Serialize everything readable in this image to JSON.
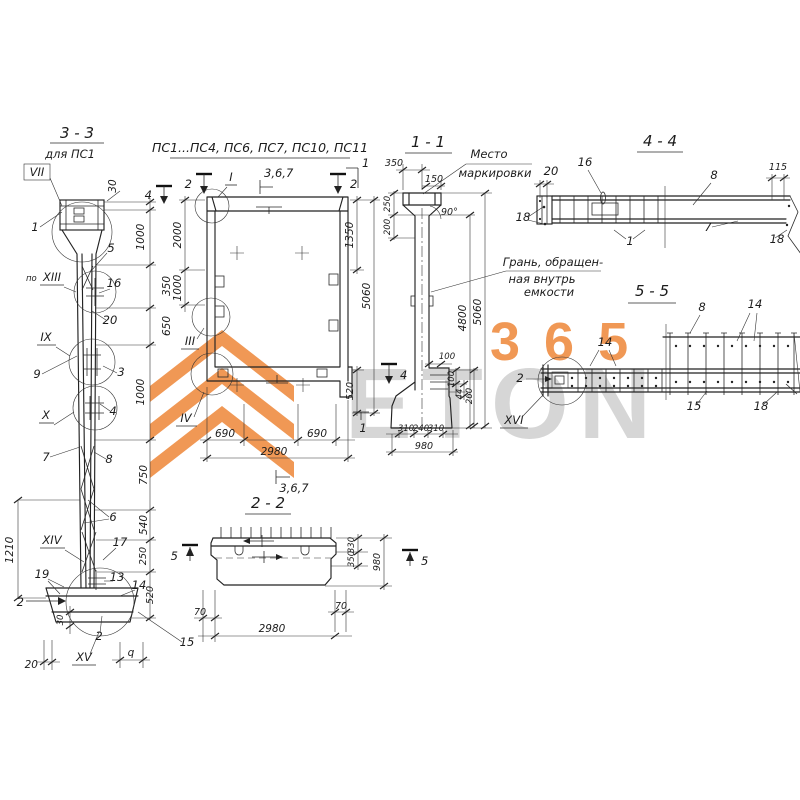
{
  "meta": {
    "bg": "#ffffff",
    "ink": "#222222"
  },
  "watermark": {
    "number": "365",
    "brand": "ETON",
    "orange": "#ee8a3e",
    "gray": "#cccccc"
  },
  "v33": {
    "title": "3 - 3",
    "subtitle": "для ПС1",
    "det_vii": "VII",
    "det_po": "по",
    "det_xiii": "XIII",
    "det_ix": "IX",
    "det_x": "X",
    "det_xiv": "XIV",
    "det_xv": "XV",
    "c1": "1",
    "c5": "5",
    "c16": "16",
    "c20": "20",
    "c9": "9",
    "c3": "3",
    "c4": "4",
    "c7": "7",
    "c8": "8",
    "c6": "6",
    "c17": "17",
    "c19": "19",
    "c13": "13",
    "c14": "14",
    "c2_side": "2",
    "c2_bottom": "2",
    "c15": "15",
    "cq": "q",
    "d30_top": "30",
    "d1000_a": "1000",
    "d350": "350",
    "d650": "650",
    "d1000_b": "1000",
    "d750": "750",
    "d540": "540",
    "d250": "250",
    "d520": "520",
    "d1210": "1210",
    "d30_base": "30",
    "d20": "20"
  },
  "vp": {
    "title": "ПС1...ПС4, ПС6, ПС7, ПС10, ПС11",
    "det_i": "I",
    "det_iii": "III",
    "det_iv": "IV",
    "mark2_left": "2",
    "mark2_right": "2",
    "mark1_top": "1",
    "mark1_bottom": "1",
    "mark4": "4",
    "g367_top": "3,6,7",
    "g367_bottom": "3,6,7",
    "d2000": "2000",
    "d1350": "1350",
    "d1000": "1000",
    "d5060": "5060",
    "d520": "520",
    "d690_a": "690",
    "d690_b": "690",
    "d2980": "2980"
  },
  "v11": {
    "title": "1 - 1",
    "d350": "350",
    "d150": "150",
    "d250": "250",
    "d200": "200",
    "angle": "90°",
    "d4800": "4800",
    "d5060": "5060",
    "d100_a": "100",
    "d100_b": "100",
    "d44": "44",
    "d260": "260",
    "d310_a": "310",
    "d240": "240",
    "d310_b": "310",
    "d980": "980",
    "mark4": "4",
    "note_marking_1": "Место",
    "note_marking_2": "маркировки",
    "note_face_1": "Грань, обращен-",
    "note_face_2": "ная внутрь",
    "note_face_3": "емкости"
  },
  "v44": {
    "title": "4 - 4",
    "c16": "16",
    "d20": "20",
    "c8": "8",
    "d115": "115",
    "c18_left": "18",
    "c7": "7",
    "c18_right": "18",
    "c1": "1"
  },
  "v55": {
    "title": "5 - 5",
    "c8": "8",
    "c14_right": "14",
    "c14_left": "14",
    "c2": "2",
    "c15": "15",
    "c18": "18",
    "det_xvi": "XVI"
  },
  "v22": {
    "title": "2 - 2",
    "d70_left": "70",
    "d70_right": "70",
    "d2980": "2980",
    "d330": "330",
    "d350": "350",
    "d980": "980",
    "mark5_left": "5",
    "mark5_right": "5"
  }
}
